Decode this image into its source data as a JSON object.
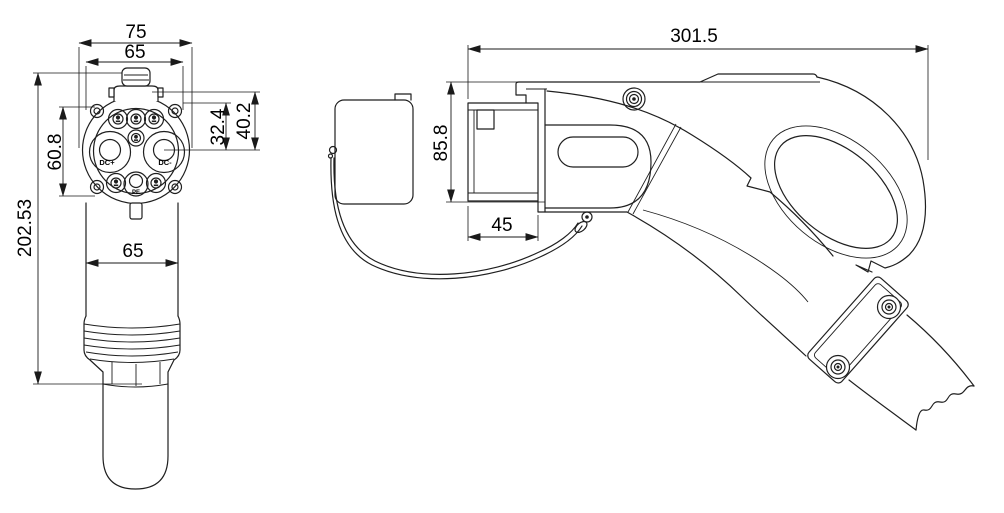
{
  "drawing": {
    "front_view": {
      "dims": {
        "flange_width": "75",
        "face_diameter": "65",
        "upper_pin_height": "32.4",
        "outer_pin_height": "40.2",
        "pin_circle_span": "60.8",
        "overall_height": "202.53",
        "body_width": "65"
      },
      "pins": {
        "dc_plus": "DC+",
        "dc_minus": "DC-",
        "pe": "PE"
      }
    },
    "side_view": {
      "dims": {
        "overall_length": "301.5",
        "body_height": "85.8",
        "nose_depth": "45"
      }
    },
    "colors": {
      "line": "#1f1f1f",
      "text": "#000000",
      "background": "#ffffff"
    }
  }
}
